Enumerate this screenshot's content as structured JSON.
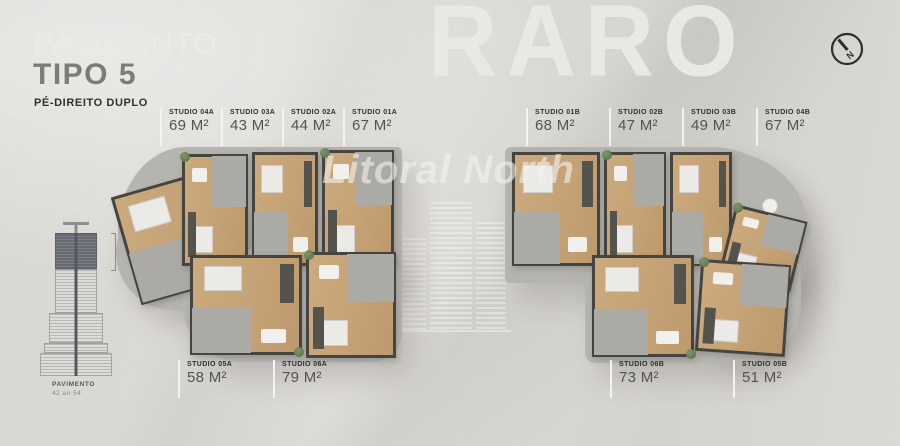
{
  "header": {
    "title_line1": "PAVIMENTO",
    "title_line2": "TIPO 5",
    "subtitle": "PÉ-DIREITO DUPLO"
  },
  "watermarks": {
    "brand": "RARO",
    "secondary": "Litoral North"
  },
  "building_diagram": {
    "caption_line1": "PAVIMENTO",
    "caption_line2": "42 ao 54",
    "highlighted_floors_color": "#696b73"
  },
  "compass": {
    "label": "N"
  },
  "colors": {
    "background": "#d9d7d2",
    "slab": "#b6b4af",
    "wood_floor": "#c4a276",
    "wall": "#45443f",
    "label_text": "#2f2e2b",
    "area_text": "#55534f"
  },
  "units": {
    "top_left": [
      {
        "name": "STUDIO 04A",
        "area": "69 M²"
      },
      {
        "name": "STUDIO 03A",
        "area": "43 M²"
      },
      {
        "name": "STUDIO 02A",
        "area": "44 M²"
      },
      {
        "name": "STUDIO 01A",
        "area": "67 M²"
      }
    ],
    "top_right": [
      {
        "name": "STUDIO 01B",
        "area": "68 M²"
      },
      {
        "name": "STUDIO 02B",
        "area": "47 M²"
      },
      {
        "name": "STUDIO 03B",
        "area": "49 M²"
      },
      {
        "name": "STUDIO 04B",
        "area": "67 M²"
      }
    ],
    "bottom_left": [
      {
        "name": "STUDIO 05A",
        "area": "58 M²"
      },
      {
        "name": "STUDIO 06A",
        "area": "79 M²"
      }
    ],
    "bottom_right": [
      {
        "name": "STUDIO 06B",
        "area": "73 M²"
      },
      {
        "name": "STUDIO 05B",
        "area": "51 M²"
      }
    ]
  }
}
